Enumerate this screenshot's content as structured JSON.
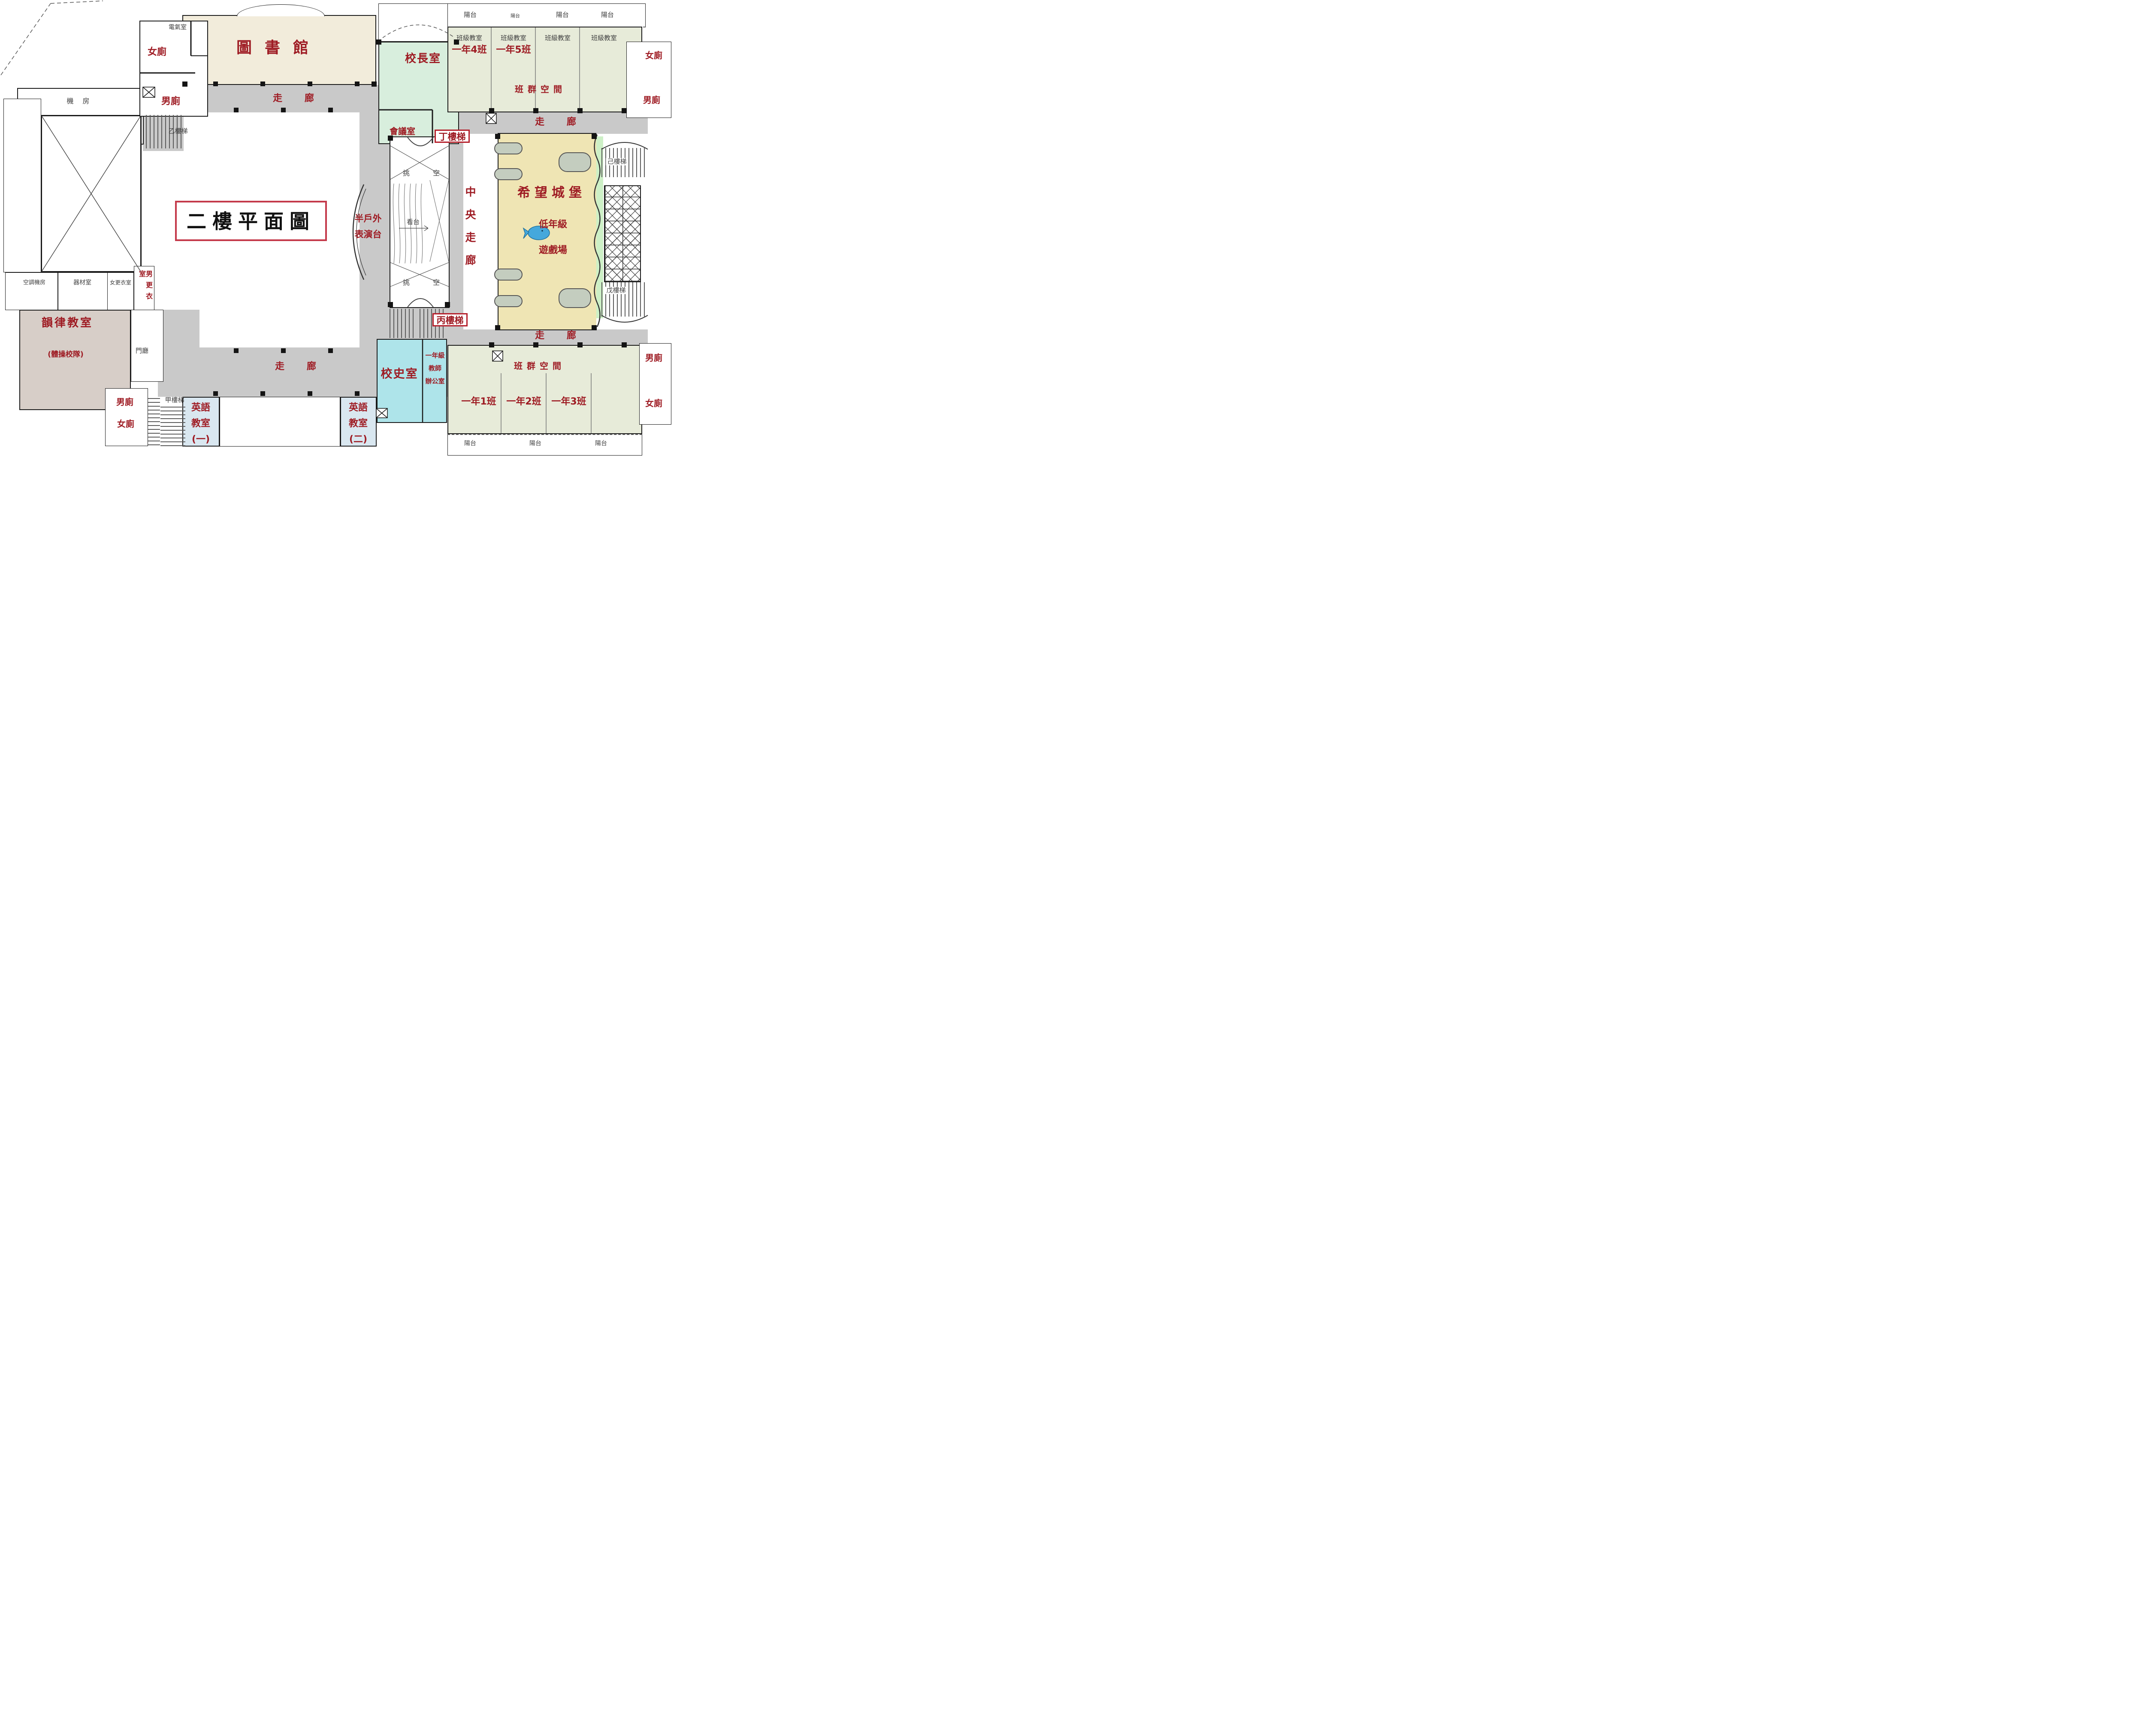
{
  "title": "二樓平面圖",
  "colors": {
    "label_red": "#9e1b23",
    "title_border": "#c43a4b",
    "wall": "#1a1a1a",
    "corridor_gray": "#c9c9c9",
    "library_beige": "#f2ecdb",
    "principal_mint": "#d8eedd",
    "classroom_sage": "#e7ebd9",
    "castle_tan": "#efe5b4",
    "history_cyan": "#aee4ea",
    "english_blue": "#d9e7f0",
    "rhythm_mauve": "#d7cec8",
    "green_strip": "#cdf0c6",
    "gray_text": "#3f3f3f",
    "whale_blue": "#45a8dc"
  },
  "rooms": {
    "library": "圖書館",
    "principal": "校長室",
    "meeting": "會議室",
    "history": "校史室",
    "rhythm": "韻律教室",
    "rhythm_team": "(體操校隊)",
    "foyer": "門廳",
    "machine": "機 房",
    "electrical": "電氣室",
    "ac_machine": "空調機房",
    "equipment": "器材室",
    "changing_f": "女更衣室",
    "changing_m": "男更衣室",
    "hope_castle": "希望城堡",
    "castle_sub1": "低年級",
    "castle_sub2": "遊戲場",
    "class_group": "班群空間",
    "classroom": "班級教室",
    "class_1_1": "一年1班",
    "class_1_2": "一年2班",
    "class_1_3": "一年3班",
    "class_1_4": "一年4班",
    "class_1_5": "一年5班",
    "english_l1": "英語",
    "english_l2": "教室",
    "english1_no": "(一)",
    "english2_no": "(二)",
    "teacher_l1": "一年級",
    "teacher_l2": "教師",
    "teacher_l3": "辦公室",
    "toilet_f": "女廁",
    "toilet_m": "男廁"
  },
  "circulation": {
    "corridor": "走 廊",
    "central_corridor": "中央走廊",
    "stage_l1": "半戶外",
    "stage_l2": "表演台",
    "stand": "看台",
    "void_l": "挑",
    "void_r": "空",
    "balcony": "陽台",
    "stairs": {
      "a": "甲樓梯",
      "b": "乙樓梯",
      "c": "丙樓梯",
      "d": "丁樓梯",
      "e": "戊樓梯",
      "f": "己樓梯"
    }
  }
}
